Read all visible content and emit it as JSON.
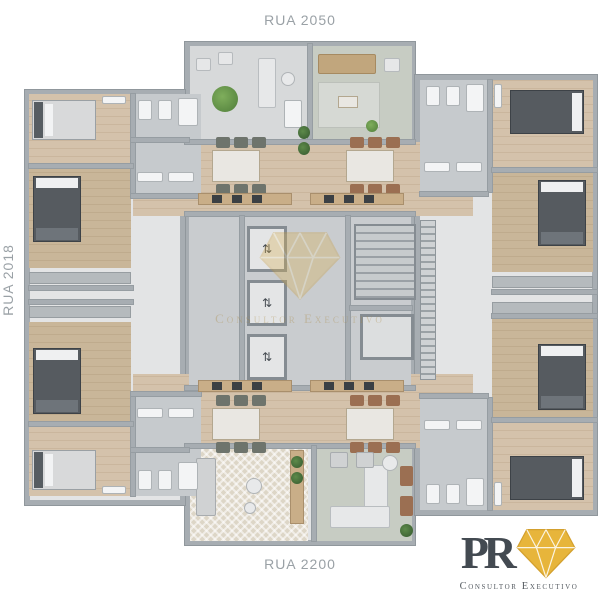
{
  "labels": {
    "street_top": "RUA 2050",
    "street_bottom": "RUA 2200",
    "street_left": "RUA 2018"
  },
  "logo": {
    "monogram": "PR",
    "tagline": "Consultor Executivo"
  },
  "watermark": {
    "text": "Consultor Executivo"
  },
  "palette": {
    "background": "#ffffff",
    "wall": "#a7adb2",
    "wood_floor": "#d2c0a8",
    "tile_floor": "#c6cacd",
    "terrace_floor": "#d7d9da",
    "carpet": "#c7ccc3",
    "bed_dark": "#565b60",
    "bed_light": "#d8d9da",
    "sofa_tan": "#c1a67d",
    "counter_wood": "#c9ae88",
    "plant_green": "#5e8f45",
    "logo_gold": "#e7b53b",
    "logo_text": "#434a51",
    "street_label": "#9aa1a6",
    "watermark_gold": "#c8a35c"
  },
  "plan": {
    "icons": {
      "elevator": "⇅"
    },
    "names": {
      "shell": "building-wing",
      "wood": "bedroom-floor",
      "wood2": "bedroom-floor",
      "tile": "bathroom-floor",
      "tileL": "terrace-floor",
      "coretile": "core-floor",
      "carpet": "living-carpet",
      "carpet2": "living-rug",
      "wall": "wall",
      "bedLh": "bed",
      "bedDh": "bed",
      "bedDv": "bed",
      "tbl": "dining-table",
      "chair": "chair",
      "chairB": "chair",
      "chairW": "armchair",
      "sofaT": "sofa",
      "sofaG": "sofa",
      "sofaW": "sofa",
      "counter": "kitchen-counter",
      "counterG": "wardrobe",
      "appl": "appliance",
      "plant": "plant",
      "plantD": "plant",
      "fix": "bathroom-fixture",
      "roundT": "side-table",
      "rug": "rug",
      "elev": "elevator",
      "stairs": "staircase",
      "shaft": "shaft",
      "vents": "utility-shaft"
    },
    "shapes": [
      [
        "shell",
        185,
        42,
        230,
        503
      ],
      [
        "shell",
        25,
        90,
        160,
        415
      ],
      [
        "shell",
        415,
        75,
        182,
        440
      ],
      [
        "tileL",
        190,
        46,
        118,
        96
      ],
      [
        "carpet",
        312,
        46,
        100,
        96
      ],
      [
        "wood",
        133,
        142,
        170,
        74
      ],
      [
        "wood",
        303,
        142,
        170,
        74
      ],
      [
        "wood",
        133,
        374,
        170,
        74
      ],
      [
        "wood",
        303,
        374,
        170,
        74
      ],
      [
        "coretile",
        189,
        216,
        222,
        170
      ],
      [
        "carpet2",
        190,
        446,
        118,
        95
      ],
      [
        "carpet",
        316,
        446,
        96,
        95
      ],
      [
        "wood",
        29,
        94,
        102,
        70
      ],
      [
        "wood2",
        29,
        168,
        102,
        100
      ],
      [
        "wood2",
        29,
        322,
        102,
        100
      ],
      [
        "wood",
        29,
        426,
        102,
        70
      ],
      [
        "tile",
        133,
        94,
        68,
        100
      ],
      [
        "tile",
        133,
        396,
        68,
        100
      ],
      [
        "tile",
        420,
        80,
        68,
        112
      ],
      [
        "tile",
        420,
        398,
        68,
        112
      ],
      [
        "wood",
        492,
        80,
        101,
        88
      ],
      [
        "wood2",
        492,
        172,
        101,
        100
      ],
      [
        "wood2",
        492,
        318,
        101,
        100
      ],
      [
        "wood",
        492,
        422,
        101,
        88
      ],
      [
        "wall",
        308,
        44,
        4,
        98
      ],
      [
        "wall",
        185,
        140,
        230,
        4
      ],
      [
        "wall",
        185,
        212,
        230,
        4
      ],
      [
        "wall",
        185,
        386,
        230,
        4
      ],
      [
        "wall",
        240,
        216,
        4,
        170
      ],
      [
        "wall",
        346,
        216,
        4,
        170
      ],
      [
        "wall",
        185,
        444,
        230,
        4
      ],
      [
        "wall",
        312,
        446,
        4,
        95
      ],
      [
        "wall",
        131,
        94,
        4,
        104
      ],
      [
        "wall",
        131,
        392,
        4,
        104
      ],
      [
        "wall",
        29,
        164,
        104,
        4
      ],
      [
        "wall",
        29,
        286,
        104,
        4
      ],
      [
        "wall",
        29,
        300,
        104,
        4
      ],
      [
        "wall",
        29,
        422,
        104,
        4
      ],
      [
        "wall",
        488,
        80,
        4,
        112
      ],
      [
        "wall",
        488,
        398,
        4,
        112
      ],
      [
        "wall",
        492,
        168,
        105,
        4
      ],
      [
        "wall",
        492,
        290,
        105,
        4
      ],
      [
        "wall",
        492,
        314,
        105,
        4
      ],
      [
        "wall",
        492,
        418,
        105,
        4
      ],
      [
        "wall",
        350,
        306,
        62,
        4
      ],
      [
        "wall",
        131,
        138,
        58,
        4
      ],
      [
        "wall",
        131,
        448,
        58,
        4
      ],
      [
        "wall",
        131,
        194,
        70,
        4
      ],
      [
        "wall",
        131,
        392,
        70,
        4
      ],
      [
        "wall",
        420,
        192,
        68,
        4
      ],
      [
        "wall",
        420,
        394,
        68,
        4
      ],
      [
        "elev",
        247,
        226,
        40,
        46
      ],
      [
        "elev",
        247,
        280,
        40,
        46
      ],
      [
        "elev",
        247,
        334,
        40,
        46
      ],
      [
        "stairs",
        354,
        224,
        62,
        76
      ],
      [
        "shaft",
        360,
        314,
        54,
        46
      ],
      [
        "vents",
        420,
        220,
        16,
        160
      ],
      [
        "bedLh",
        32,
        100,
        64,
        40
      ],
      [
        "bedDv",
        33,
        176,
        48,
        66
      ],
      [
        "bedDv",
        33,
        348,
        48,
        66
      ],
      [
        "bedLh",
        32,
        450,
        64,
        40
      ],
      [
        "bedDh",
        510,
        90,
        74,
        44
      ],
      [
        "bedDv",
        538,
        180,
        48,
        66
      ],
      [
        "bedDv",
        538,
        344,
        48,
        66
      ],
      [
        "bedDh",
        510,
        456,
        74,
        44
      ],
      [
        "counterG",
        29,
        272,
        102,
        12
      ],
      [
        "counterG",
        29,
        306,
        102,
        12
      ],
      [
        "counterG",
        492,
        276,
        101,
        12
      ],
      [
        "counterG",
        492,
        302,
        101,
        12
      ],
      [
        "tbl",
        212,
        150,
        48,
        32
      ],
      [
        "chair",
        216,
        137,
        14,
        11
      ],
      [
        "chair",
        234,
        137,
        14,
        11
      ],
      [
        "chair",
        252,
        137,
        14,
        11
      ],
      [
        "chair",
        216,
        184,
        14,
        11
      ],
      [
        "chair",
        234,
        184,
        14,
        11
      ],
      [
        "chair",
        252,
        184,
        14,
        11
      ],
      [
        "tbl",
        346,
        150,
        48,
        32
      ],
      [
        "chairB",
        350,
        137,
        14,
        11
      ],
      [
        "chairB",
        368,
        137,
        14,
        11
      ],
      [
        "chairB",
        386,
        137,
        14,
        11
      ],
      [
        "chairB",
        350,
        184,
        14,
        11
      ],
      [
        "chairB",
        368,
        184,
        14,
        11
      ],
      [
        "chairB",
        386,
        184,
        14,
        11
      ],
      [
        "tbl",
        212,
        408,
        48,
        32
      ],
      [
        "chair",
        216,
        395,
        14,
        11
      ],
      [
        "chair",
        234,
        395,
        14,
        11
      ],
      [
        "chair",
        252,
        395,
        14,
        11
      ],
      [
        "chair",
        216,
        442,
        14,
        11
      ],
      [
        "chair",
        234,
        442,
        14,
        11
      ],
      [
        "chair",
        252,
        442,
        14,
        11
      ],
      [
        "tbl",
        346,
        408,
        48,
        32
      ],
      [
        "chairB",
        350,
        395,
        14,
        11
      ],
      [
        "chairB",
        368,
        395,
        14,
        11
      ],
      [
        "chairB",
        386,
        395,
        14,
        11
      ],
      [
        "chairB",
        350,
        442,
        14,
        11
      ],
      [
        "chairB",
        368,
        442,
        14,
        11
      ],
      [
        "chairB",
        386,
        442,
        14,
        11
      ],
      [
        "counter",
        198,
        193,
        94,
        12
      ],
      [
        "appl",
        212,
        195,
        10,
        8
      ],
      [
        "appl",
        232,
        195,
        10,
        8
      ],
      [
        "appl",
        252,
        195,
        10,
        8
      ],
      [
        "counter",
        310,
        193,
        94,
        12
      ],
      [
        "appl",
        324,
        195,
        10,
        8
      ],
      [
        "appl",
        344,
        195,
        10,
        8
      ],
      [
        "appl",
        364,
        195,
        10,
        8
      ],
      [
        "counter",
        198,
        380,
        94,
        12
      ],
      [
        "appl",
        212,
        382,
        10,
        8
      ],
      [
        "appl",
        232,
        382,
        10,
        8
      ],
      [
        "appl",
        252,
        382,
        10,
        8
      ],
      [
        "counter",
        310,
        380,
        94,
        12
      ],
      [
        "appl",
        324,
        382,
        10,
        8
      ],
      [
        "appl",
        344,
        382,
        10,
        8
      ],
      [
        "appl",
        364,
        382,
        10,
        8
      ],
      [
        "chairW",
        196,
        58,
        15,
        13
      ],
      [
        "chairW",
        218,
        52,
        15,
        13
      ],
      [
        "plant",
        212,
        86,
        26,
        26
      ],
      [
        "sofaW",
        258,
        58,
        18,
        50
      ],
      [
        "roundT",
        281,
        72,
        14,
        14
      ],
      [
        "fix",
        284,
        100,
        18,
        28
      ],
      [
        "sofaT",
        318,
        54,
        58,
        20
      ],
      [
        "rug",
        318,
        82,
        62,
        46
      ],
      [
        "tbl",
        338,
        96,
        20,
        12
      ],
      [
        "chairW",
        384,
        58,
        16,
        14
      ],
      [
        "plant",
        366,
        120,
        12,
        12
      ],
      [
        "plantD",
        298,
        126,
        12,
        13
      ],
      [
        "plantD",
        298,
        142,
        12,
        13
      ],
      [
        "sofaG",
        196,
        458,
        20,
        58
      ],
      [
        "roundT",
        246,
        478,
        16,
        16
      ],
      [
        "roundT",
        244,
        502,
        12,
        12
      ],
      [
        "counter",
        290,
        450,
        14,
        74
      ],
      [
        "plantD",
        291,
        456,
        12,
        12
      ],
      [
        "plantD",
        291,
        472,
        12,
        12
      ],
      [
        "sofaW",
        364,
        465,
        24,
        55
      ],
      [
        "sofaW",
        330,
        506,
        60,
        22
      ],
      [
        "sofaG",
        330,
        452,
        18,
        16
      ],
      [
        "sofaG",
        356,
        452,
        18,
        16
      ],
      [
        "roundT",
        382,
        455,
        16,
        16
      ],
      [
        "chairB",
        400,
        466,
        13,
        20
      ],
      [
        "chairB",
        400,
        496,
        13,
        20
      ],
      [
        "plantD",
        400,
        524,
        13,
        13
      ],
      [
        "fix",
        138,
        100,
        14,
        20
      ],
      [
        "fix",
        158,
        100,
        14,
        20
      ],
      [
        "fix",
        178,
        98,
        20,
        28
      ],
      [
        "fix",
        137,
        172,
        26,
        10
      ],
      [
        "fix",
        168,
        172,
        26,
        10
      ],
      [
        "fix",
        138,
        470,
        14,
        20
      ],
      [
        "fix",
        158,
        470,
        14,
        20
      ],
      [
        "fix",
        178,
        462,
        20,
        28
      ],
      [
        "fix",
        137,
        408,
        26,
        10
      ],
      [
        "fix",
        168,
        408,
        26,
        10
      ],
      [
        "fix",
        426,
        86,
        14,
        20
      ],
      [
        "fix",
        446,
        86,
        14,
        20
      ],
      [
        "fix",
        466,
        84,
        18,
        28
      ],
      [
        "fix",
        424,
        162,
        26,
        10
      ],
      [
        "fix",
        456,
        162,
        26,
        10
      ],
      [
        "fix",
        426,
        484,
        14,
        20
      ],
      [
        "fix",
        446,
        484,
        14,
        20
      ],
      [
        "fix",
        466,
        478,
        18,
        28
      ],
      [
        "fix",
        424,
        420,
        26,
        10
      ],
      [
        "fix",
        456,
        420,
        26,
        10
      ],
      [
        "fix",
        102,
        96,
        24,
        8
      ],
      [
        "fix",
        102,
        486,
        24,
        8
      ],
      [
        "fix",
        494,
        84,
        8,
        24
      ],
      [
        "fix",
        494,
        482,
        8,
        24
      ]
    ]
  }
}
